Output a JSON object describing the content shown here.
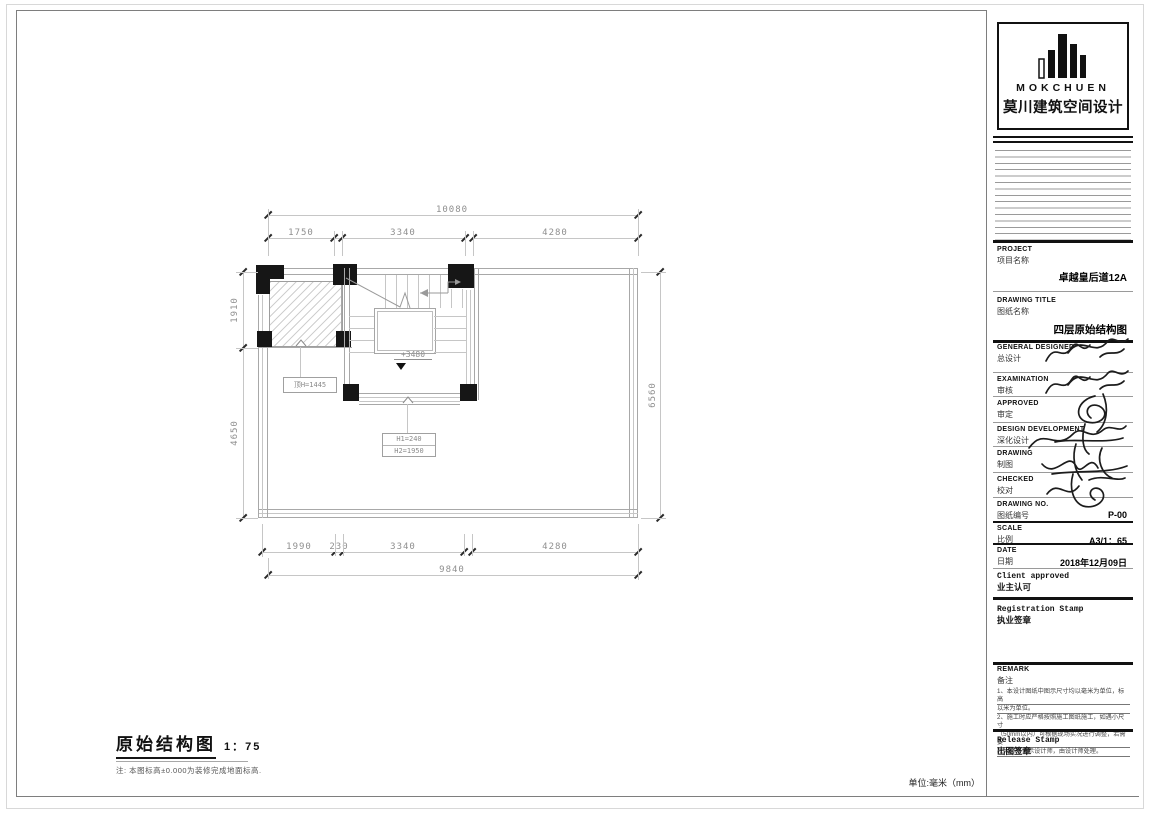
{
  "logo": {
    "brand_en": "MOKCHUEN",
    "brand_cn": "莫川建筑空间设计"
  },
  "titleblock": {
    "project_en": "PROJECT",
    "project_cn": "项目名称",
    "project_value": "卓越皇后道12A",
    "drawing_title_en": "DRAWING TITLE",
    "drawing_title_cn": "图纸名称",
    "drawing_title_value": "四层原始结构图",
    "rows": [
      {
        "en": "GENERAL  DESIGNED",
        "cn": "总设计"
      },
      {
        "en": "EXAMINATION",
        "cn": "审核"
      },
      {
        "en": "APPROVED",
        "cn": "审定"
      },
      {
        "en": "DESIGN DEVELOPMENT",
        "cn": "深化设计"
      },
      {
        "en": "DRAWING",
        "cn": "制图"
      },
      {
        "en": "CHECKED",
        "cn": "校对"
      }
    ],
    "drawing_no_en": "DRAWING NO.",
    "drawing_no_cn": "图纸编号",
    "drawing_no_value": "P-00",
    "scale_en": "SCALE",
    "scale_cn": "比例",
    "scale_value": "A3/1：65",
    "date_en": "DATE",
    "date_cn": "日期",
    "date_value": "2018年12月09日",
    "client_en": "Client approved",
    "client_cn": "业主认可",
    "registration_en": "Registration Stamp",
    "registration_cn": "执业签章",
    "remark_en": "REMARK",
    "remark_cn": "备注",
    "remark_lines": [
      "1、本设计图纸中图示尺寸均以毫米为单位，标高",
      "以米为单位。",
      "2、施工时应严格按照施工图纸施工，如遇小尺寸",
      "（50mm以内）可根据现场实况进行调整，若需要",
      "较大必须请示设计师，由设计师处理。"
    ],
    "release_en": "Release Stamp",
    "release_cn": "出图签章"
  },
  "plan": {
    "dims_top": {
      "total": "10080",
      "segments": [
        "1750",
        "3340",
        "4280"
      ]
    },
    "dims_bottom": {
      "total": "9840",
      "segments": [
        "1990",
        "230",
        "3340",
        "4280"
      ]
    },
    "dims_left": [
      "1910",
      "4650"
    ],
    "dims_right": [
      "6560"
    ],
    "level_label": "+3480",
    "label_top": "顶H=1445",
    "label_h1": "H1=240",
    "label_h2": "H2=1950"
  },
  "footer": {
    "title": "原始结构图",
    "scale": "1：75",
    "note": "注: 本图标高±0.000为装修完成地面标高.",
    "unit": "单位:毫米（mm）"
  }
}
